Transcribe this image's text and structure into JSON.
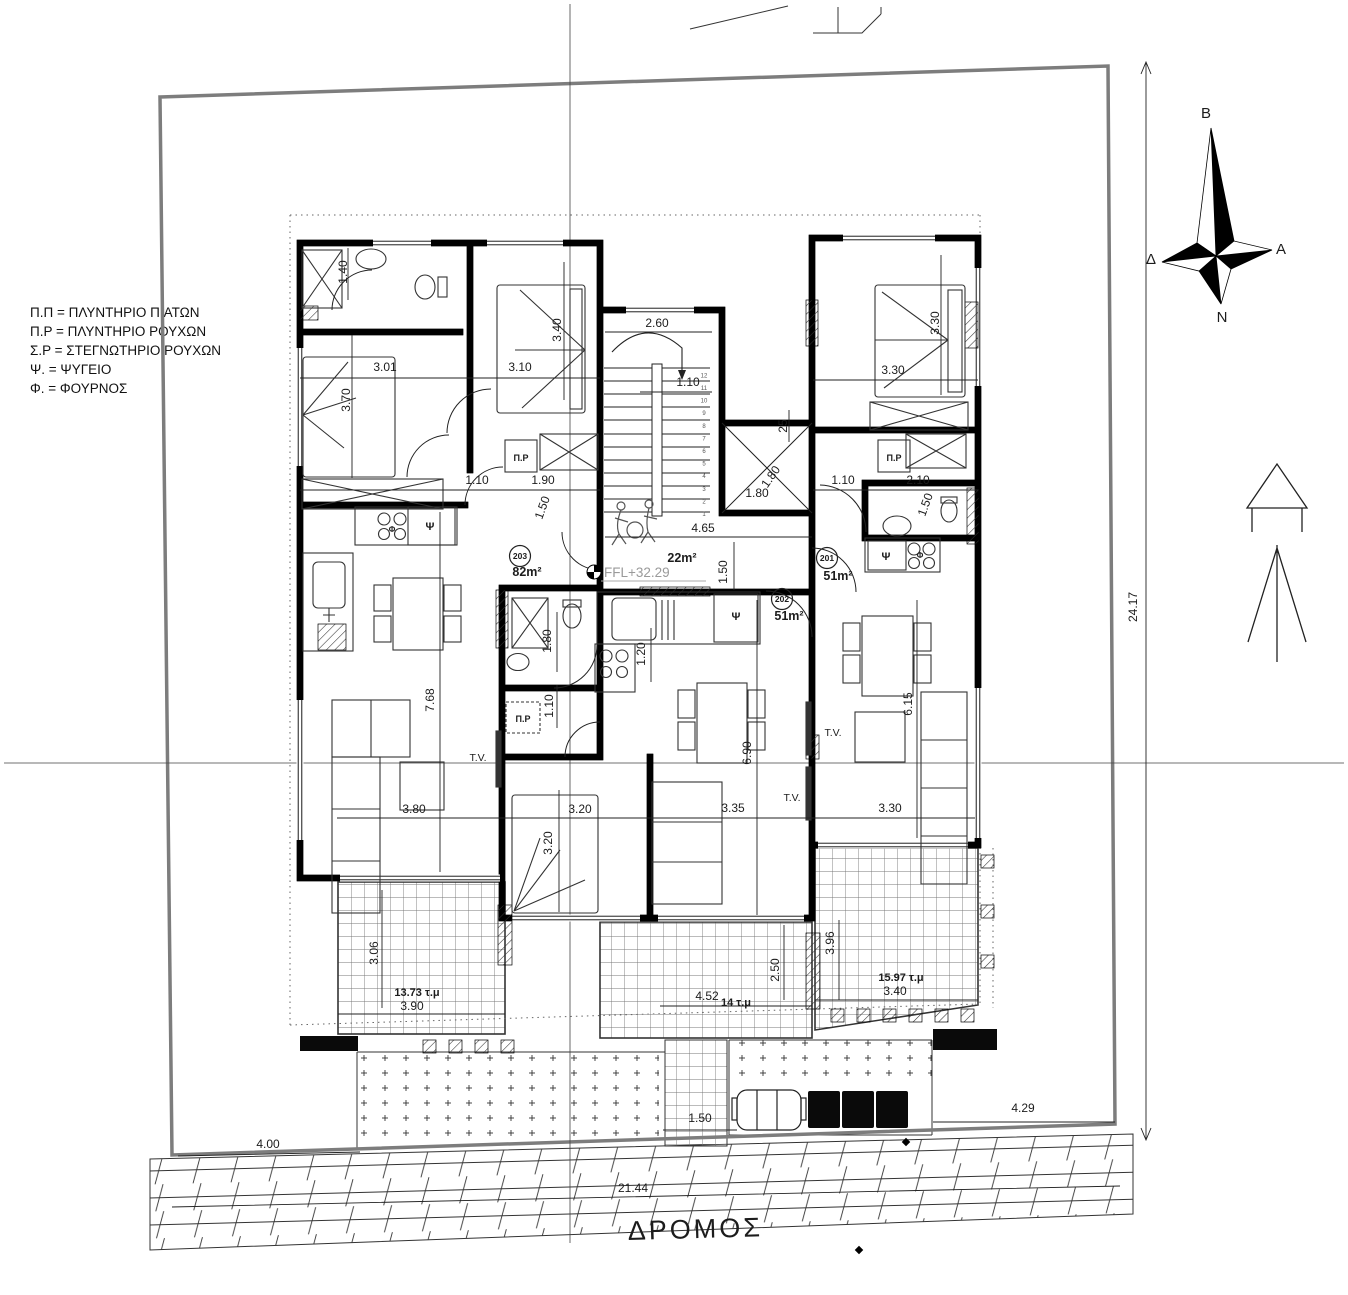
{
  "legend": {
    "items": [
      "Π.Π = ΠΛΥΝΤΗΡΙΟ ΠΙΑΤΩΝ",
      "Π.Ρ = ΠΛΥΝΤΗΡΙΟ ΡΟΥΧΩΝ",
      "Σ.Ρ = ΣΤΕΓΝΩΤΗΡΙΟ ΡΟΥΧΩΝ",
      "Ψ. = ΨΥΓΕΙΟ",
      "Φ. = ΦΟΥΡΝΟΣ"
    ]
  },
  "compass": {
    "north": "Β",
    "south": "Ν",
    "east": "Α",
    "west": "Δ"
  },
  "road": {
    "label": "ΔΡΟΜΟΣ"
  },
  "plan": {
    "ffl_label": "FFL+32.29",
    "stair_step_count": 12,
    "units": [
      {
        "number": "203",
        "x": 520,
        "y": 556
      },
      {
        "number": "202",
        "x": 782,
        "y": 599
      },
      {
        "number": "201",
        "x": 827,
        "y": 558
      }
    ],
    "labels": [
      {
        "t": "1.40",
        "x": 347,
        "y": 272,
        "r": -90
      },
      {
        "t": "3.01",
        "x": 385,
        "y": 371
      },
      {
        "t": "3.70",
        "x": 350,
        "y": 400,
        "r": -90
      },
      {
        "t": "3.10",
        "x": 520,
        "y": 371
      },
      {
        "t": "3.40",
        "x": 561,
        "y": 330,
        "r": -90
      },
      {
        "t": "2.60",
        "x": 657,
        "y": 327
      },
      {
        "t": "1.10",
        "x": 688,
        "y": 386
      },
      {
        "t": "25",
        "x": 787,
        "y": 426,
        "r": -90
      },
      {
        "t": "3.30",
        "x": 939,
        "y": 323,
        "r": -90
      },
      {
        "t": "3.30",
        "x": 893,
        "y": 374
      },
      {
        "t": "1.10",
        "x": 477,
        "y": 484
      },
      {
        "t": "1.90",
        "x": 543,
        "y": 484
      },
      {
        "t": "1.50",
        "x": 546,
        "y": 509,
        "r": -70
      },
      {
        "t": "1.10",
        "x": 843,
        "y": 484
      },
      {
        "t": "2.10",
        "x": 918,
        "y": 484
      },
      {
        "t": "1.50",
        "x": 929,
        "y": 506,
        "r": -70
      },
      {
        "t": "1.80",
        "x": 757,
        "y": 497
      },
      {
        "t": "1.80",
        "x": 774,
        "y": 479,
        "r": -55
      },
      {
        "t": "4.65",
        "x": 703,
        "y": 532
      },
      {
        "t": "1.50",
        "x": 727,
        "y": 572,
        "r": -90
      },
      {
        "t": "1.80",
        "x": 551,
        "y": 641,
        "r": -90
      },
      {
        "t": "1.20",
        "x": 645,
        "y": 654,
        "r": -90
      },
      {
        "t": "1.10",
        "x": 553,
        "y": 706,
        "r": -90
      },
      {
        "t": "7.68",
        "x": 434,
        "y": 700,
        "r": -90
      },
      {
        "t": "3.80",
        "x": 414,
        "y": 813
      },
      {
        "t": "3.20",
        "x": 580,
        "y": 813
      },
      {
        "t": "3.20",
        "x": 552,
        "y": 843,
        "r": -90
      },
      {
        "t": "3.35",
        "x": 733,
        "y": 812
      },
      {
        "t": "6.90",
        "x": 751,
        "y": 753,
        "r": -90
      },
      {
        "t": "6.15",
        "x": 912,
        "y": 704,
        "r": -90
      },
      {
        "t": "3.30",
        "x": 890,
        "y": 812
      },
      {
        "t": "3.06",
        "x": 378,
        "y": 953,
        "r": -90
      },
      {
        "t": "3.90",
        "x": 412,
        "y": 1010
      },
      {
        "t": "4.52",
        "x": 707,
        "y": 1000
      },
      {
        "t": "2.50",
        "x": 779,
        "y": 970,
        "r": -90
      },
      {
        "t": "3.96",
        "x": 834,
        "y": 943,
        "r": -90
      },
      {
        "t": "3.40",
        "x": 895,
        "y": 995
      },
      {
        "t": "1.50",
        "x": 700,
        "y": 1122
      },
      {
        "t": "4.00",
        "x": 268,
        "y": 1148
      },
      {
        "t": "4.29",
        "x": 1023,
        "y": 1112
      },
      {
        "t": "21.44",
        "x": 633,
        "y": 1192
      },
      {
        "t": "24.17",
        "x": 1137,
        "y": 607,
        "r": -90
      },
      {
        "t": "22m²",
        "x": 682,
        "y": 562,
        "cls": "area"
      },
      {
        "t": "82m²",
        "x": 527,
        "y": 576,
        "cls": "area"
      },
      {
        "t": "51m²",
        "x": 789,
        "y": 620,
        "cls": "area"
      },
      {
        "t": "51m²",
        "x": 838,
        "y": 580,
        "cls": "area"
      },
      {
        "t": "13.73 τ.μ",
        "x": 417,
        "y": 996,
        "cls": "area2"
      },
      {
        "t": "14 τ.μ",
        "x": 736,
        "y": 1006,
        "cls": "area2"
      },
      {
        "t": "15.97 τ.μ",
        "x": 901,
        "y": 981,
        "cls": "area2"
      },
      {
        "t": "Ψ",
        "x": 430,
        "y": 530,
        "cls": "app"
      },
      {
        "t": "Φ",
        "x": 392,
        "y": 532,
        "cls": "apps"
      },
      {
        "t": "Ψ",
        "x": 736,
        "y": 620,
        "cls": "app"
      },
      {
        "t": "Ψ",
        "x": 886,
        "y": 560,
        "cls": "app"
      },
      {
        "t": "Φ",
        "x": 920,
        "y": 558,
        "cls": "apps"
      },
      {
        "t": "Π.Ρ",
        "x": 521,
        "y": 461,
        "cls": "pr"
      },
      {
        "t": "Π.Ρ",
        "x": 894,
        "y": 461,
        "cls": "pr"
      },
      {
        "t": "Π.Ρ",
        "x": 523,
        "y": 722,
        "cls": "pr"
      },
      {
        "t": "T.V.",
        "x": 478,
        "y": 761,
        "cls": "tv"
      },
      {
        "t": "T.V.",
        "x": 792,
        "y": 801,
        "cls": "tv"
      },
      {
        "t": "T.V.",
        "x": 833,
        "y": 736,
        "cls": "tv"
      }
    ]
  }
}
